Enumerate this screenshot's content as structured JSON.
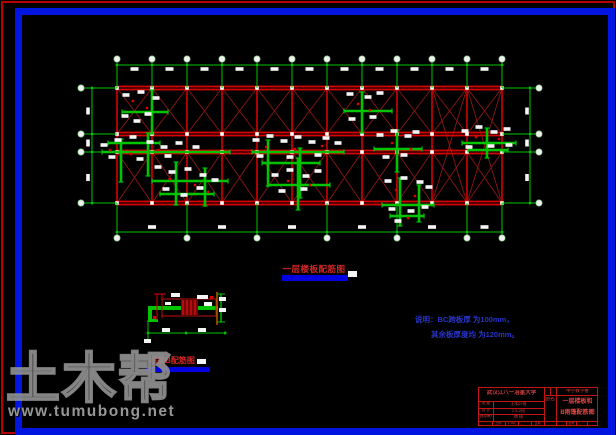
{
  "watermark": {
    "brand": "土木帮",
    "url": "www.tumubong.net"
  },
  "labels": {
    "plan_title": "一层楼板配筋图",
    "detail_title": "雨篷B配筋图",
    "note_line1": "说明：BC跨板厚 为100mm，",
    "note_line2": "其余板厚度均 为120mm。"
  },
  "title_block": {
    "school": "武汉江八一冶星大学",
    "project": "中学教学楼",
    "name_label": "图名",
    "drawing_name_line1": "一层楼板和",
    "drawing_name_line2": "B雨篷配筋图",
    "rows": [
      {
        "label": "班 级",
        "value": "土木07班"
      },
      {
        "label": "设 计",
        "value": "2.5-2班"
      },
      {
        "label": "指导教师",
        "value": "审 核"
      }
    ],
    "footer_cells": [
      "比例",
      "1:100",
      "日期",
      "图号"
    ]
  },
  "colors": {
    "cad_red": "#d80000",
    "cad_dark_red": "#8c1616",
    "cad_green": "#00c400",
    "bubble_fill": "#f0f0f0",
    "blob_white": "#f5f5f5",
    "mark_red": "#e00000"
  },
  "plan": {
    "x0": 117,
    "x1": 502,
    "rows_y": [
      88,
      134,
      152,
      203
    ],
    "n_cols": 12,
    "dim_top_y": 65,
    "bubble_top_y": 59,
    "dim_bottom_y": 232,
    "bubble_bottom_y": 238,
    "dim_left_x": 92,
    "bubble_left_x": 81,
    "dim_right_x": 530,
    "bubble_right_x": 539,
    "bottom_ext_cols": [
      0,
      2,
      4,
      6,
      8,
      10,
      11
    ]
  },
  "clusters": [
    {
      "v": [
        [
          152,
          90,
          134
        ]
      ],
      "h": [
        [
          122,
          168,
          112
        ]
      ],
      "b": [
        [
          126,
          95
        ],
        [
          141,
          92
        ],
        [
          156,
          98
        ],
        [
          125,
          116
        ],
        [
          148,
          114
        ],
        [
          137,
          121
        ]
      ],
      "r": [
        [
          133,
          101
        ],
        [
          147,
          108
        ]
      ]
    },
    {
      "v": [
        [
          121,
          139,
          182
        ],
        [
          148,
          133,
          176
        ]
      ],
      "h": [
        [
          102,
          230,
          152
        ],
        [
          108,
          160,
          143
        ]
      ],
      "b": [
        [
          104,
          145
        ],
        [
          118,
          140
        ],
        [
          133,
          137
        ],
        [
          150,
          142
        ],
        [
          164,
          147
        ],
        [
          179,
          143
        ],
        [
          196,
          147
        ],
        [
          112,
          157
        ],
        [
          140,
          159
        ],
        [
          168,
          156
        ]
      ],
      "r": [
        [
          110,
          150
        ],
        [
          131,
          154
        ],
        [
          158,
          150
        ]
      ]
    },
    {
      "v": [
        [
          176,
          162,
          205
        ],
        [
          205,
          168,
          206
        ]
      ],
      "h": [
        [
          152,
          228,
          181
        ],
        [
          160,
          214,
          194
        ]
      ],
      "b": [
        [
          158,
          167
        ],
        [
          172,
          172
        ],
        [
          188,
          169
        ],
        [
          203,
          175
        ],
        [
          215,
          180
        ],
        [
          166,
          189
        ],
        [
          184,
          195
        ],
        [
          200,
          188
        ]
      ],
      "r": [
        [
          170,
          179
        ],
        [
          195,
          185
        ],
        [
          208,
          192
        ]
      ]
    },
    {
      "v": [
        [
          268,
          140,
          186
        ],
        [
          300,
          148,
          198
        ]
      ],
      "h": [
        [
          252,
          344,
          152
        ],
        [
          262,
          320,
          163
        ]
      ],
      "b": [
        [
          256,
          140
        ],
        [
          270,
          136
        ],
        [
          284,
          141
        ],
        [
          298,
          137
        ],
        [
          312,
          142
        ],
        [
          326,
          138
        ],
        [
          338,
          143
        ],
        [
          260,
          156
        ],
        [
          290,
          157
        ],
        [
          318,
          155
        ]
      ],
      "r": [
        [
          266,
          147
        ],
        [
          295,
          149
        ],
        [
          322,
          146
        ]
      ]
    },
    {
      "v": [
        [
          298,
          158,
          210
        ]
      ],
      "h": [
        [
          268,
          330,
          185
        ]
      ],
      "b": [
        [
          275,
          175
        ],
        [
          290,
          170
        ],
        [
          306,
          176
        ],
        [
          318,
          171
        ],
        [
          282,
          191
        ],
        [
          304,
          189
        ]
      ],
      "r": [
        [
          288,
          181
        ],
        [
          310,
          185
        ]
      ]
    },
    {
      "v": [
        [
          362,
          92,
          133
        ]
      ],
      "h": [
        [
          344,
          392,
          111
        ]
      ],
      "b": [
        [
          350,
          94
        ],
        [
          368,
          97
        ],
        [
          380,
          93
        ],
        [
          352,
          119
        ],
        [
          373,
          117
        ]
      ],
      "r": [
        [
          358,
          104
        ],
        [
          370,
          110
        ]
      ]
    },
    {
      "v": [
        [
          397,
          130,
          172
        ]
      ],
      "h": [
        [
          374,
          422,
          149
        ]
      ],
      "b": [
        [
          380,
          135
        ],
        [
          394,
          131
        ],
        [
          408,
          136
        ],
        [
          416,
          132
        ],
        [
          386,
          157
        ],
        [
          404,
          155
        ]
      ],
      "r": [
        [
          392,
          143
        ],
        [
          411,
          149
        ]
      ]
    },
    {
      "v": [
        [
          400,
          178,
          226
        ],
        [
          419,
          185,
          222
        ]
      ],
      "h": [
        [
          382,
          434,
          205
        ],
        [
          390,
          424,
          216
        ]
      ],
      "b": [
        [
          388,
          181
        ],
        [
          404,
          178
        ],
        [
          420,
          182
        ],
        [
          429,
          187
        ],
        [
          392,
          209
        ],
        [
          411,
          211
        ],
        [
          425,
          207
        ],
        [
          398,
          221
        ]
      ],
      "r": [
        [
          396,
          190
        ],
        [
          415,
          196
        ],
        [
          408,
          218
        ]
      ]
    },
    {
      "v": [
        [
          487,
          128,
          158
        ]
      ],
      "h": [
        [
          462,
          516,
          143
        ],
        [
          468,
          508,
          150
        ]
      ],
      "b": [
        [
          465,
          131
        ],
        [
          479,
          127
        ],
        [
          494,
          132
        ],
        [
          507,
          129
        ],
        [
          469,
          147
        ],
        [
          491,
          146
        ],
        [
          509,
          145
        ]
      ],
      "r": [
        [
          476,
          137
        ],
        [
          499,
          139
        ]
      ]
    }
  ]
}
